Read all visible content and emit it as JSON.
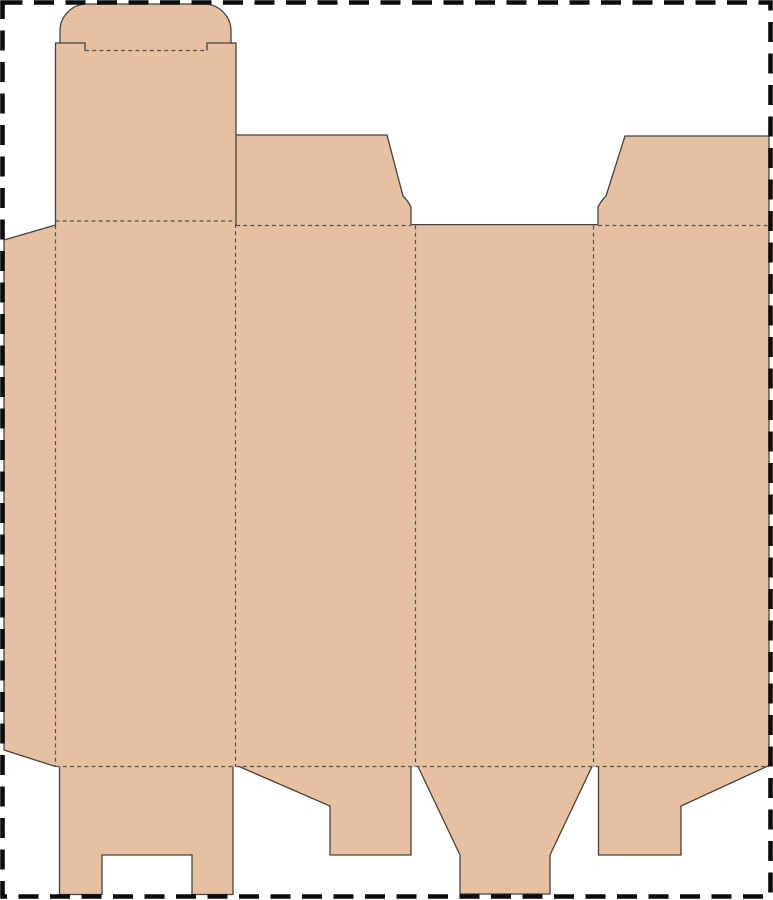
{
  "canvas": {
    "width": 773,
    "height": 900,
    "background": "#ffffff"
  },
  "page_border": {
    "x": 2.5,
    "y": 2.5,
    "width": 768,
    "height": 894,
    "color": "#0c0c0c",
    "stroke_width": 4.6,
    "dash": "20 11.5"
  },
  "dieline": {
    "board_color": "#e5c1a1",
    "cut_color": "#49423b",
    "cut_width": 1.3,
    "fold_color": "#55504a",
    "fold_width": 1.2,
    "fold_dash": "4 3.2",
    "blank_path": "M 4 240 L 55.5 225 L 55.5 43 L 60 43 L 60 31 A 27 27 0 0 1 87 4 L 204 4 A 27 27 0 0 1 231 31 L 231 43 L 236 43 L 236 135 L 387 135 L 403 196 Q 408 201 411 207 L 411 224.6 L 598 224.6 L 598 207 Q 601 201 606 196 L 625 136 L 769 136 L 769 765.5 L 681 806 L 681 855 L 598.5 855 L 598.5 766.5 L 592 766.5 L 550 855 L 550 894 L 460 894 L 460 855 L 418 766.5 L 411 766.5 L 411 855 L 330 855 L 330 806 L 239 766.5 L 233 766.5 L 233 894.5 L 192 894.5 L 192 855 L 102 855 L 102 894.5 L 59.5 894.5 L 59.5 766.5 L 55.5 766.5 L 4 750 Z",
    "cuts": [
      {
        "name": "glue-flap-cut",
        "d": "M 55.5 225 L 4 240 L 4 750 L 55.5 766.5"
      },
      {
        "name": "back-panel-and-tuck-flap-cut",
        "d": "M 55.5 225 L 55.5 43 L 60 43 L 60 31 A 27 27 0 0 1 87 4 L 204 4 A 27 27 0 0 1 231 31 L 231 43 L 236 43 L 236 225"
      },
      {
        "name": "tuck-shoulder-left-cut",
        "d": "M 60 43 L 85 43 L 85 50.5"
      },
      {
        "name": "tuck-shoulder-right-cut",
        "d": "M 207 50.5 L 207 43 L 231 43"
      },
      {
        "name": "dust-flap-left-cut",
        "d": "M 236 135 L 387 135 L 403 196 Q 408 201 411 207 L 411 224.6"
      },
      {
        "name": "top-gap-edge-cut",
        "d": "M 411 224.6 L 598 224.6"
      },
      {
        "name": "dust-flap-right-cut",
        "d": "M 598 224.6 L 598 207 Q 601 201 606 196 L 625 136 L 769 136"
      },
      {
        "name": "right-sheet-edge-cut",
        "d": "M 769 136 L 769 765.5"
      },
      {
        "name": "bottom-flap-right-angled-cut",
        "d": "M 769 765.5 L 681 806 L 681 855 L 598.5 855 L 598.5 766.5"
      },
      {
        "name": "bottom-tongue-flap-cut",
        "d": "M 592 766.5 L 550 855 L 550 894 L 460 894 L 460 855 L 418 766.5"
      },
      {
        "name": "bottom-flap-left-angled-cut",
        "d": "M 411 766.5 L 411 855 L 330 855 L 330 806 L 239 766.5"
      },
      {
        "name": "bottom-notched-flap-cut",
        "d": "M 233 766.5 L 233 894.5 L 192 894.5 L 192 855 L 102 855 L 102 894.5 L 59.5 894.5 L 59.5 766.5"
      }
    ],
    "folds": [
      {
        "name": "tuck-flap-fold",
        "x1": 85,
        "y1": 50.5,
        "x2": 207,
        "y2": 50.5
      },
      {
        "name": "back-panel-top-fold",
        "x1": 55.5,
        "y1": 221,
        "x2": 235,
        "y2": 221
      },
      {
        "name": "top-fold-left-dust-flap",
        "x1": 236,
        "y1": 225.5,
        "x2": 411,
        "y2": 225.5
      },
      {
        "name": "top-fold-right-dust-flap",
        "x1": 598,
        "y1": 225.5,
        "x2": 769,
        "y2": 225.5
      },
      {
        "name": "bottom-fold",
        "x1": 55.5,
        "y1": 766.5,
        "x2": 769,
        "y2": 766.5
      },
      {
        "name": "glue-flap-fold",
        "x1": 55.5,
        "y1": 225,
        "x2": 55.5,
        "y2": 766.5
      },
      {
        "name": "panel-fold-1",
        "x1": 235.5,
        "y1": 224,
        "x2": 235.5,
        "y2": 766.5
      },
      {
        "name": "panel-fold-2",
        "x1": 415.5,
        "y1": 225.5,
        "x2": 415.5,
        "y2": 766.5
      },
      {
        "name": "panel-fold-3",
        "x1": 593.5,
        "y1": 225.5,
        "x2": 593.5,
        "y2": 766.5
      }
    ]
  }
}
